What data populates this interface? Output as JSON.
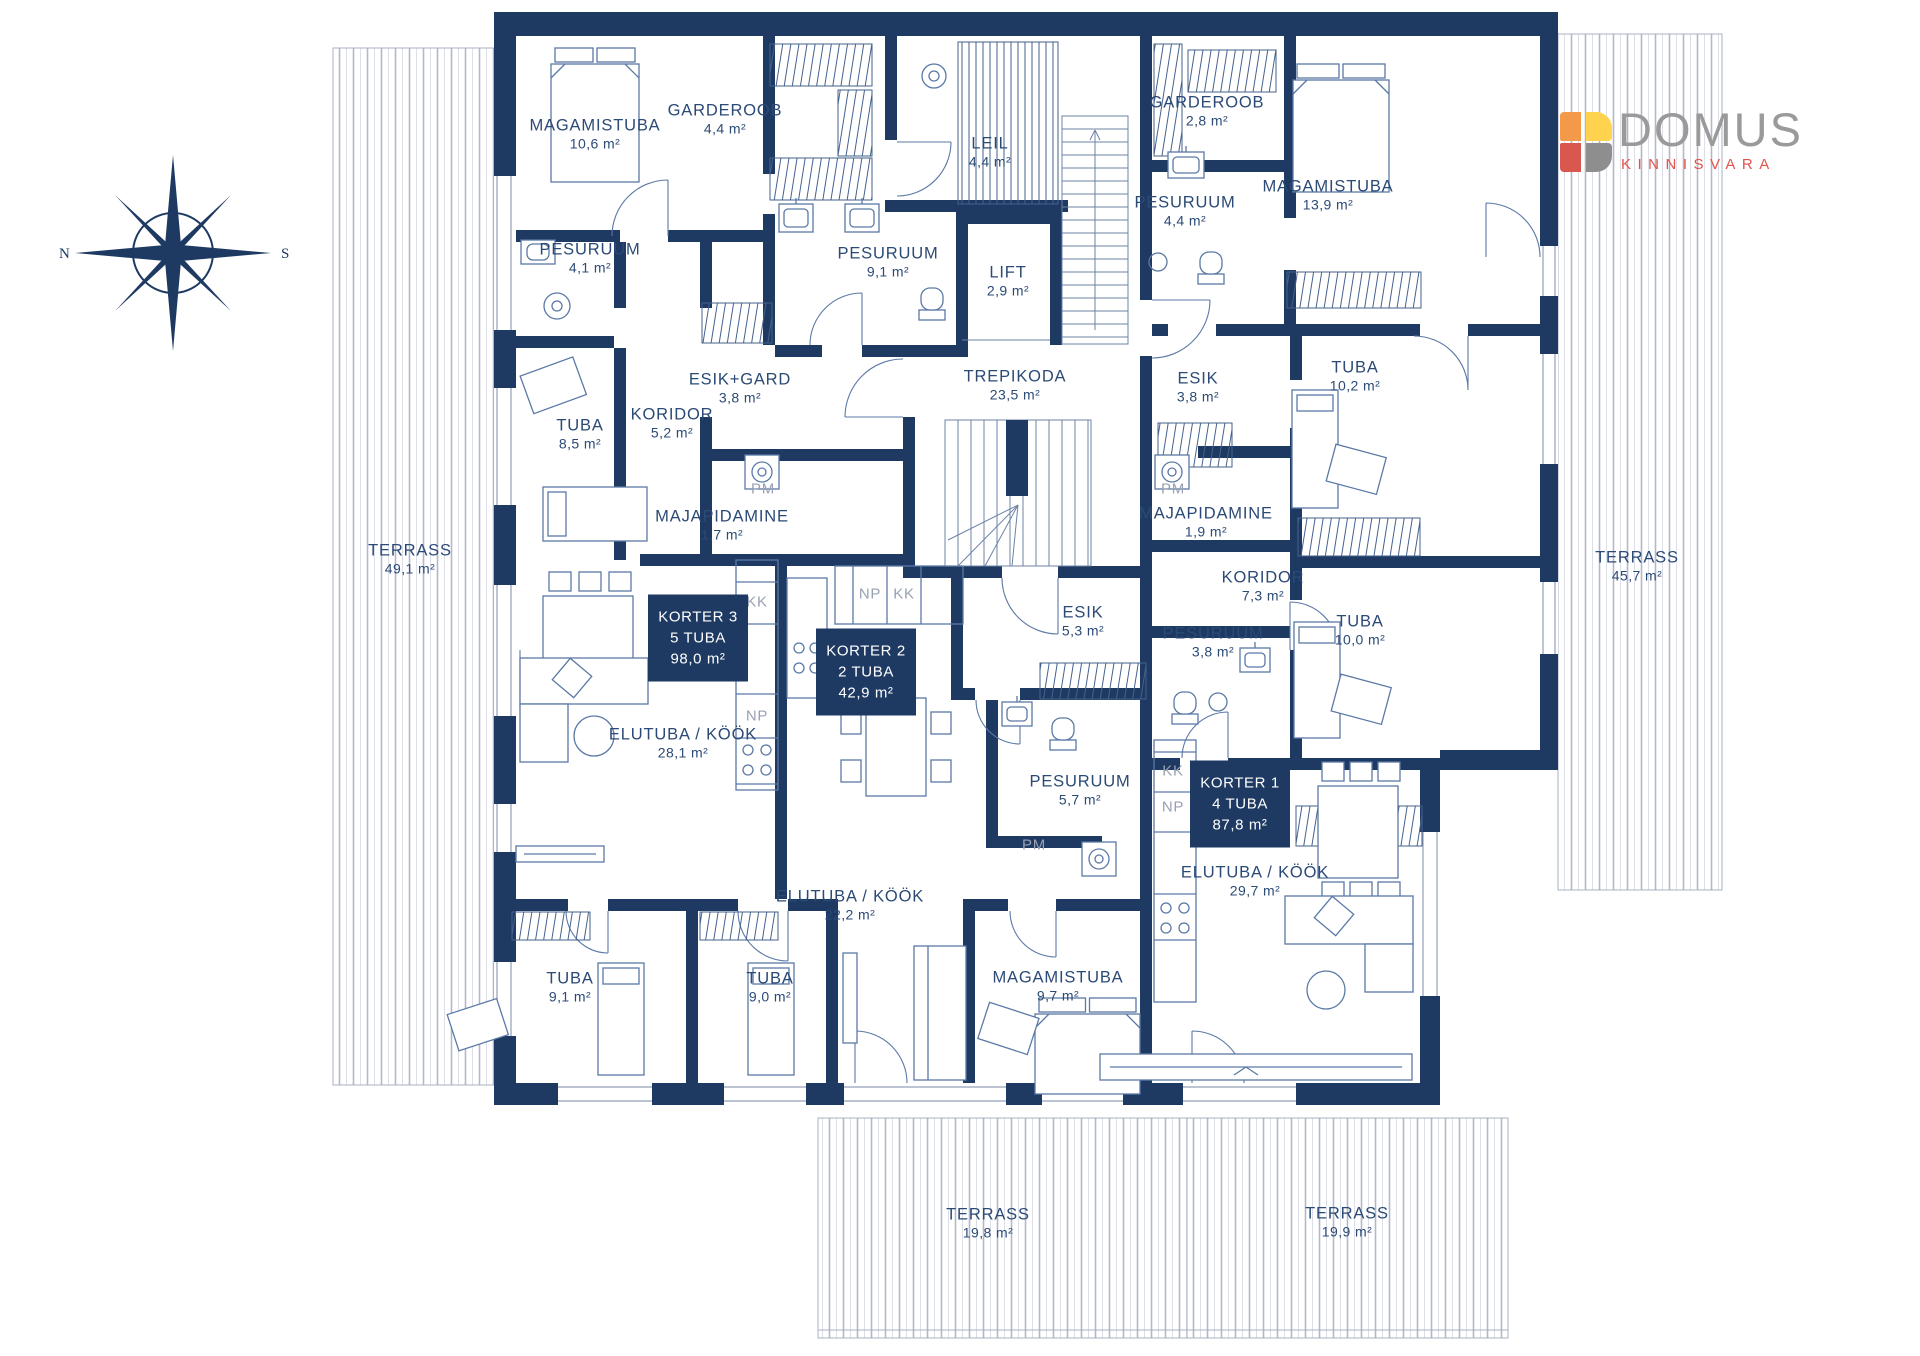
{
  "branding": {
    "name": "DOMUS",
    "subtitle": "KINNISVARA"
  },
  "compass": {
    "left": "N",
    "right": "S"
  },
  "apartments": [
    {
      "name": "KORTER 3",
      "rooms": "5 TUBA",
      "area": "98,0 m²",
      "x": 698,
      "y": 638
    },
    {
      "name": "KORTER 2",
      "rooms": "2 TUBA",
      "area": "42,9 m²",
      "x": 866,
      "y": 672
    },
    {
      "name": "KORTER 1",
      "rooms": "4 TUBA",
      "area": "87,8 m²",
      "x": 1240,
      "y": 804
    }
  ],
  "room_labels": [
    {
      "name": "MAGAMISTUBA",
      "area": "10,6 m²",
      "x": 595,
      "y": 134
    },
    {
      "name": "GARDEROOB",
      "area": "4,4 m²",
      "x": 725,
      "y": 119
    },
    {
      "name": "LEIL",
      "area": "4,4 m²",
      "x": 990,
      "y": 152
    },
    {
      "name": "PESURUUM",
      "area": "4,1 m²",
      "x": 590,
      "y": 258
    },
    {
      "name": "PESURUUM",
      "area": "9,1 m²",
      "x": 888,
      "y": 262
    },
    {
      "name": "LIFT",
      "area": "2,9 m²",
      "x": 1008,
      "y": 281
    },
    {
      "name": "ESIK+GARD",
      "area": "3,8 m²",
      "x": 740,
      "y": 388
    },
    {
      "name": "KORIDOR",
      "area": "5,2 m²",
      "x": 672,
      "y": 423
    },
    {
      "name": "TUBA",
      "area": "8,5 m²",
      "x": 580,
      "y": 434
    },
    {
      "name": "TREPIKODA",
      "area": "23,5 m²",
      "x": 1015,
      "y": 385
    },
    {
      "name": "MAJAPIDAMINE",
      "area": "1,7 m²",
      "x": 722,
      "y": 525
    },
    {
      "name": "MAJAPIDAMINE",
      "area": "1,9 m²",
      "x": 1206,
      "y": 522
    },
    {
      "name": "GARDEROOB",
      "area": "2,8 m²",
      "x": 1207,
      "y": 111
    },
    {
      "name": "PESURUUM",
      "area": "4,4 m²",
      "x": 1185,
      "y": 211
    },
    {
      "name": "MAGAMISTUBA",
      "area": "13,9 m²",
      "x": 1328,
      "y": 195
    },
    {
      "name": "ESIK",
      "area": "3,8 m²",
      "x": 1198,
      "y": 387
    },
    {
      "name": "TUBA",
      "area": "10,2 m²",
      "x": 1355,
      "y": 376
    },
    {
      "name": "KORIDOR",
      "area": "7,3 m²",
      "x": 1263,
      "y": 586
    },
    {
      "name": "TUBA",
      "area": "10,0 m²",
      "x": 1360,
      "y": 630
    },
    {
      "name": "PESURUUM",
      "area": "3,8 m²",
      "x": 1213,
      "y": 642
    },
    {
      "name": "ESIK",
      "area": "5,3 m²",
      "x": 1083,
      "y": 621
    },
    {
      "name": "PESURUUM",
      "area": "5,7 m²",
      "x": 1080,
      "y": 790
    },
    {
      "name": "ELUTUBA / KÖÖK",
      "area": "28,1 m²",
      "x": 683,
      "y": 743
    },
    {
      "name": "ELUTUBA / KÖÖK",
      "area": "22,2 m²",
      "x": 850,
      "y": 905
    },
    {
      "name": "ELUTUBA / KÖÖK",
      "area": "29,7 m²",
      "x": 1255,
      "y": 881
    },
    {
      "name": "MAGAMISTUBA",
      "area": "9,7 m²",
      "x": 1058,
      "y": 986
    },
    {
      "name": "TUBA",
      "area": "9,1 m²",
      "x": 570,
      "y": 987
    },
    {
      "name": "TUBA",
      "area": "9,0 m²",
      "x": 770,
      "y": 987
    },
    {
      "name": "TERRASS",
      "area": "49,1 m²",
      "x": 410,
      "y": 559
    },
    {
      "name": "TERRASS",
      "area": "45,7 m²",
      "x": 1637,
      "y": 566
    },
    {
      "name": "TERRASS",
      "area": "19,8 m²",
      "x": 988,
      "y": 1223
    },
    {
      "name": "TERRASS",
      "area": "19,9 m²",
      "x": 1347,
      "y": 1222
    }
  ],
  "appliance_labels": [
    {
      "text": "PM",
      "x": 763,
      "y": 489
    },
    {
      "text": "PM",
      "x": 1173,
      "y": 489
    },
    {
      "text": "PM",
      "x": 1034,
      "y": 845
    },
    {
      "text": "KK",
      "x": 757,
      "y": 602
    },
    {
      "text": "NP",
      "x": 757,
      "y": 716
    },
    {
      "text": "NP",
      "x": 870,
      "y": 594
    },
    {
      "text": "KK",
      "x": 904,
      "y": 594
    },
    {
      "text": "KK",
      "x": 1173,
      "y": 771
    },
    {
      "text": "NP",
      "x": 1173,
      "y": 807
    }
  ],
  "colors": {
    "wall": "#1e3a63",
    "text": "#2b4a76",
    "furniture": "#5b79a6",
    "logo_orange": "#F29A49",
    "logo_yellow": "#FFD34D",
    "logo_red": "#D9574F",
    "logo_gray": "#8E8E8E"
  }
}
